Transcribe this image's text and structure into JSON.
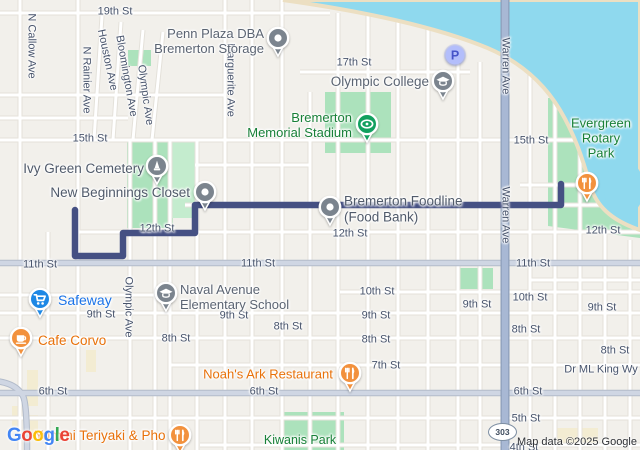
{
  "map": {
    "attribution": "Map data ©2025 Google",
    "shield_label": "303",
    "google_logo": [
      {
        "ch": "G",
        "color": "#4285F4"
      },
      {
        "ch": "o",
        "color": "#EA4335"
      },
      {
        "ch": "o",
        "color": "#FBBC05"
      },
      {
        "ch": "g",
        "color": "#4285F4"
      },
      {
        "ch": "l",
        "color": "#34A853"
      },
      {
        "ch": "e",
        "color": "#EA4335"
      }
    ],
    "colors": {
      "street_label": "#47536b",
      "poi_gray": "#5b6472",
      "poi_dark": "#505a6a",
      "park_green": "#188038",
      "restaurant_orange": "#e8710a",
      "store_blue": "#1a73e8",
      "pin_gray": "#7b848e",
      "pin_green": "#12a05f",
      "pin_orange": "#f2913d",
      "pin_blue": "#1e88e5",
      "route": "#455083",
      "water": "#8fd9ee",
      "park": "#ace2bc"
    },
    "route": {
      "color": "#455083",
      "points": [
        [
          75,
          210
        ],
        [
          75,
          256
        ],
        [
          123,
          256
        ],
        [
          123,
          233
        ],
        [
          195,
          233
        ],
        [
          195,
          205
        ],
        [
          561,
          205
        ],
        [
          561,
          184
        ]
      ]
    },
    "street_labels": [
      {
        "text": "19th St",
        "x": 115,
        "y": 12
      },
      {
        "text": "N Callow Ave",
        "x": 31,
        "y": 46,
        "rot": 90
      },
      {
        "text": "N Rainier Ave",
        "x": 86,
        "y": 80,
        "rot": 90
      },
      {
        "text": "Houston Ave",
        "x": 107,
        "y": 60,
        "rot": 78
      },
      {
        "text": "Bloomington Ave",
        "x": 126,
        "y": 76,
        "rot": 80
      },
      {
        "text": "Olympic Ave",
        "x": 145,
        "y": 95,
        "rot": 82
      },
      {
        "text": "Marguerite Ave",
        "x": 230,
        "y": 80,
        "rot": 90
      },
      {
        "text": "17th St",
        "x": 354,
        "y": 63
      },
      {
        "text": "Warren Ave",
        "x": 505,
        "y": 66,
        "rot": 90
      },
      {
        "text": "Warren Ave",
        "x": 505,
        "y": 215,
        "rot": 90
      },
      {
        "text": "15th St",
        "x": 90,
        "y": 139
      },
      {
        "text": "15th St",
        "x": 531,
        "y": 141
      },
      {
        "text": "12th St",
        "x": 157,
        "y": 229
      },
      {
        "text": "12th St",
        "x": 350,
        "y": 234
      },
      {
        "text": "12th St",
        "x": 603,
        "y": 231
      },
      {
        "text": "11th St",
        "x": 40,
        "y": 265
      },
      {
        "text": "11th St",
        "x": 258,
        "y": 264
      },
      {
        "text": "11th St",
        "x": 533,
        "y": 264
      },
      {
        "text": "Olympic Ave",
        "x": 128,
        "y": 307,
        "rot": 90
      },
      {
        "text": "10th St",
        "x": 377,
        "y": 292
      },
      {
        "text": "10th St",
        "x": 530,
        "y": 298
      },
      {
        "text": "9th St",
        "x": 101,
        "y": 315
      },
      {
        "text": "9th St",
        "x": 234,
        "y": 316
      },
      {
        "text": "9th St",
        "x": 376,
        "y": 316
      },
      {
        "text": "9th St",
        "x": 477,
        "y": 305
      },
      {
        "text": "9th St",
        "x": 602,
        "y": 308
      },
      {
        "text": "8th St",
        "x": 176,
        "y": 339
      },
      {
        "text": "8th St",
        "x": 288,
        "y": 327
      },
      {
        "text": "8th St",
        "x": 376,
        "y": 340
      },
      {
        "text": "8th St",
        "x": 526,
        "y": 330
      },
      {
        "text": "8th St",
        "x": 615,
        "y": 351
      },
      {
        "text": "7th St",
        "x": 386,
        "y": 366
      },
      {
        "text": "Dr ML King Wy",
        "x": 601,
        "y": 370
      },
      {
        "text": "6th St",
        "x": 53,
        "y": 392
      },
      {
        "text": "6th St",
        "x": 264,
        "y": 392
      },
      {
        "text": "6th St",
        "x": 528,
        "y": 392
      },
      {
        "text": "5th St",
        "x": 526,
        "y": 419
      },
      {
        "text": "4th St",
        "x": 524,
        "y": 448
      }
    ],
    "poi_labels": [
      {
        "id": "penn-plaza",
        "lines": [
          "Penn Plaza DBA",
          "Bremerton Storage"
        ],
        "x": 264,
        "y": 42,
        "color": "poi_gray",
        "size": 13,
        "align": "right"
      },
      {
        "id": "olympic-college",
        "lines": [
          "Olympic College"
        ],
        "x": 429,
        "y": 82,
        "color": "poi_gray",
        "size": 13.5,
        "align": "right"
      },
      {
        "id": "memorial-stadium",
        "lines": [
          "Bremerton",
          "Memorial Stadium"
        ],
        "x": 352,
        "y": 126,
        "color": "park_green",
        "size": 13,
        "align": "right"
      },
      {
        "id": "evergreen-rotary-park",
        "lines": [
          "Evergreen",
          "Rotary Park"
        ],
        "x": 601,
        "y": 139,
        "color": "park_green",
        "size": 13,
        "align": "center"
      },
      {
        "id": "ivy-green-cemetery",
        "lines": [
          "Ivy Green Cemetery"
        ],
        "x": 144,
        "y": 169,
        "color": "poi_dark",
        "size": 13.5,
        "align": "right"
      },
      {
        "id": "new-beginnings-closet",
        "lines": [
          "New Beginnings Closet"
        ],
        "x": 190,
        "y": 193,
        "color": "poi_dark",
        "size": 13.5,
        "align": "right"
      },
      {
        "id": "bremerton-foodline",
        "lines": [
          "Bremerton Foodline",
          "(Food Bank)"
        ],
        "x": 344,
        "y": 209,
        "color": "poi_dark",
        "size": 13.5,
        "align": "left"
      },
      {
        "id": "safeway",
        "lines": [
          "Safeway"
        ],
        "x": 58,
        "y": 300,
        "color": "store_blue",
        "size": 14,
        "align": "left"
      },
      {
        "id": "naval-avenue-school",
        "lines": [
          "Naval Avenue",
          "Elementary School"
        ],
        "x": 180,
        "y": 298,
        "color": "poi_gray",
        "size": 13,
        "align": "left"
      },
      {
        "id": "cafe-corvo",
        "lines": [
          "Cafe Corvo"
        ],
        "x": 38,
        "y": 341,
        "color": "restaurant_orange",
        "size": 13.5,
        "align": "left"
      },
      {
        "id": "noahs-ark-restaurant",
        "lines": [
          "Noah's Ark Restaurant"
        ],
        "x": 268,
        "y": 375,
        "color": "restaurant_orange",
        "size": 13,
        "align": "center"
      },
      {
        "id": "yummi-teriyaki-pho",
        "lines": [
          "Yummi Teriyaki & Pho"
        ],
        "x": 100,
        "y": 436,
        "color": "restaurant_orange",
        "size": 13.5,
        "align": "center"
      },
      {
        "id": "kiwanis-park",
        "lines": [
          "Kiwanis Park"
        ],
        "x": 300,
        "y": 440,
        "color": "park_green",
        "size": 12.5,
        "align": "center"
      }
    ],
    "pins": [
      {
        "id": "penn-plaza",
        "icon": "dot",
        "x": 278,
        "y": 38,
        "color": "pin_gray"
      },
      {
        "id": "parking",
        "icon": "parking",
        "x": 455,
        "y": 55,
        "color": "pin_blue",
        "glyph": "P"
      },
      {
        "id": "olympic-college",
        "icon": "school",
        "x": 443,
        "y": 81,
        "color": "pin_gray"
      },
      {
        "id": "memorial-stadium",
        "icon": "stadium",
        "x": 367,
        "y": 124,
        "color": "pin_green"
      },
      {
        "id": "ivy-green-cemetery",
        "icon": "monument",
        "x": 157,
        "y": 166,
        "color": "pin_gray"
      },
      {
        "id": "new-beginnings-closet",
        "icon": "dot",
        "x": 205,
        "y": 192,
        "color": "pin_gray"
      },
      {
        "id": "bremerton-foodline",
        "icon": "dot",
        "x": 330,
        "y": 207,
        "color": "pin_gray"
      },
      {
        "id": "evergreen-restaurant",
        "icon": "utensils",
        "x": 587,
        "y": 183,
        "color": "pin_orange"
      },
      {
        "id": "safeway",
        "icon": "cart",
        "x": 40,
        "y": 299,
        "color": "pin_blue"
      },
      {
        "id": "naval-avenue-school",
        "icon": "school",
        "x": 166,
        "y": 293,
        "color": "pin_gray"
      },
      {
        "id": "cafe-corvo",
        "icon": "cup",
        "x": 21,
        "y": 338,
        "color": "pin_orange"
      },
      {
        "id": "noahs-ark-restaurant",
        "icon": "utensils",
        "x": 350,
        "y": 373,
        "color": "pin_orange"
      },
      {
        "id": "yummi-teriyaki-pho",
        "icon": "utensils",
        "x": 180,
        "y": 435,
        "color": "pin_orange"
      }
    ]
  }
}
